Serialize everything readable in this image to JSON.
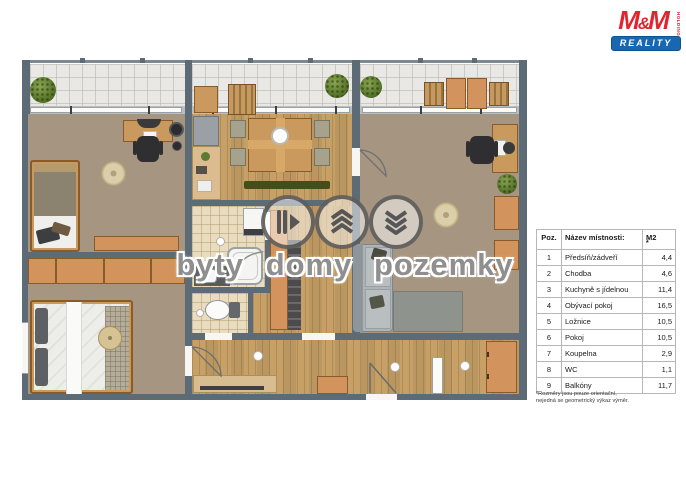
{
  "branding": {
    "logo_m1": "M",
    "logo_amp": "&",
    "logo_m2": "M",
    "logo_vertical": "HOLDING",
    "logo_banner": "REALITY",
    "brand_red": "#e0252f",
    "brand_blue": "#1a67b1"
  },
  "watermark": {
    "words": [
      "byty",
      "domy",
      "pozemky"
    ],
    "icons": [
      "double-door-arrow-icon",
      "roof-layers-icon",
      "terrain-chevrons-icon"
    ]
  },
  "room_table": {
    "headers": {
      "pos": "Poz.",
      "name": "Název místnosti:",
      "area": "M2",
      "area_note": "*"
    },
    "rows": [
      {
        "pos": "1",
        "name": "Předsíň/zádveří",
        "area": "4,4"
      },
      {
        "pos": "2",
        "name": "Chodba",
        "area": "4,6"
      },
      {
        "pos": "3",
        "name": "Kuchyně s jídelnou",
        "area": "11,4"
      },
      {
        "pos": "4",
        "name": "Obývací pokoj",
        "area": "16,5"
      },
      {
        "pos": "5",
        "name": "Ložnice",
        "area": "10,5"
      },
      {
        "pos": "6",
        "name": "Pokoj",
        "area": "10,5"
      },
      {
        "pos": "7",
        "name": "Koupelna",
        "area": "2,9"
      },
      {
        "pos": "8",
        "name": "WC",
        "area": "1,1"
      },
      {
        "pos": "9",
        "name": "Balkóny",
        "area": "11,7"
      }
    ],
    "footnote_lines": [
      "*Rozměry jsou pouze orientační,",
      "nejedná se geometrický výkaz výměr."
    ]
  },
  "palette": {
    "wall": "#5d6b76",
    "wood": "#c6a066",
    "room-tan": "#a69581",
    "tile": "#e9dcbf",
    "balcony": "#e9e8e4",
    "furniture-orange": "#d2945c",
    "furniture-wood": "#c9995e",
    "couch-gray": "#aeb3b6",
    "watermark-gray": "#8f8f8f",
    "brand-blue": "#1a67b1"
  }
}
